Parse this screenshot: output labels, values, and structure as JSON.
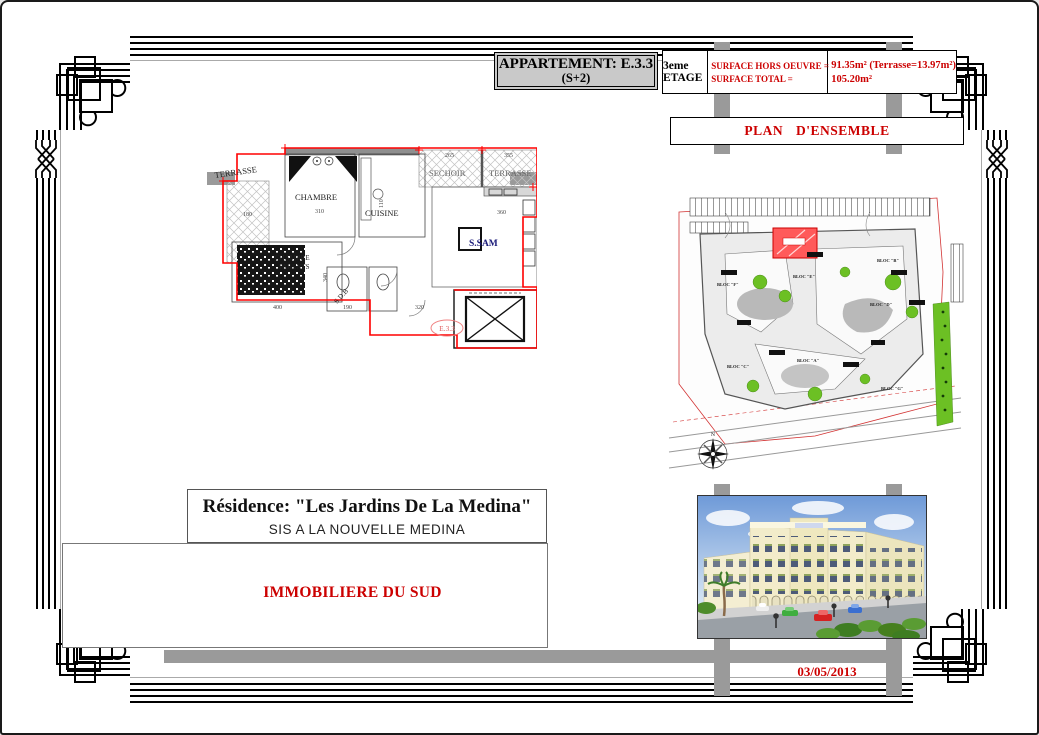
{
  "sheet": {
    "title_line1": "APPARTEMENT: E.3.3",
    "title_line2": "(S+2)",
    "date": "03/05/2013"
  },
  "surface_table": {
    "floor_label": "3eme ETAGE",
    "row1_label": "SURFACE HORS OEUVRE =",
    "row1_value": "91.35m² (Terrasse=13.97m²)",
    "row2_label": "SURFACE TOTAL =",
    "row2_value": "105.20m²"
  },
  "ensemble": {
    "title": "PLAN D'ENSEMBLE"
  },
  "residence": {
    "name": "Résidence: \"Les Jardins De La Medina\"",
    "location": "SIS A LA NOUVELLE MEDINA",
    "company": "IMMOBILIERE DU SUD"
  },
  "floor_plan": {
    "unit_label": "E.3.3",
    "rooms": {
      "terrasse_left": "TERRASSE",
      "chambre": "CHAMBRE",
      "sechoir": "SECHOIR",
      "terrasse_top": "TERRASSE",
      "cuisine": "CUISINE",
      "ssam": "S.SAM",
      "parents_1": "CHAMBRE",
      "parents_2": "PARENTS",
      "sdb": "S.D.B"
    },
    "dims": {
      "terrasse_left": "180",
      "chambre": "310",
      "sechoir": "265",
      "terrasse_top": "355",
      "ssam": "360",
      "parents_w": "400",
      "parents_h": "340",
      "sdb": "190",
      "hall": "320",
      "kitchen": "110"
    }
  },
  "site_plan": {
    "blocks": [
      "BLOC \"E\"",
      "BLOC \"F\"",
      "BLOC \"B\"",
      "BLOC \"D\"",
      "BLOC \"A\"",
      "BLOC \"C\"",
      "BLOC \"G\""
    ],
    "compass_n": "N"
  },
  "colors": {
    "accent_red": "#cc0000",
    "plan_red": "#ff0000",
    "band_gray": "#9a9a9a",
    "title_bg": "#c9c9c9",
    "green": "#6cc024",
    "navy": "#1b1b7a"
  }
}
